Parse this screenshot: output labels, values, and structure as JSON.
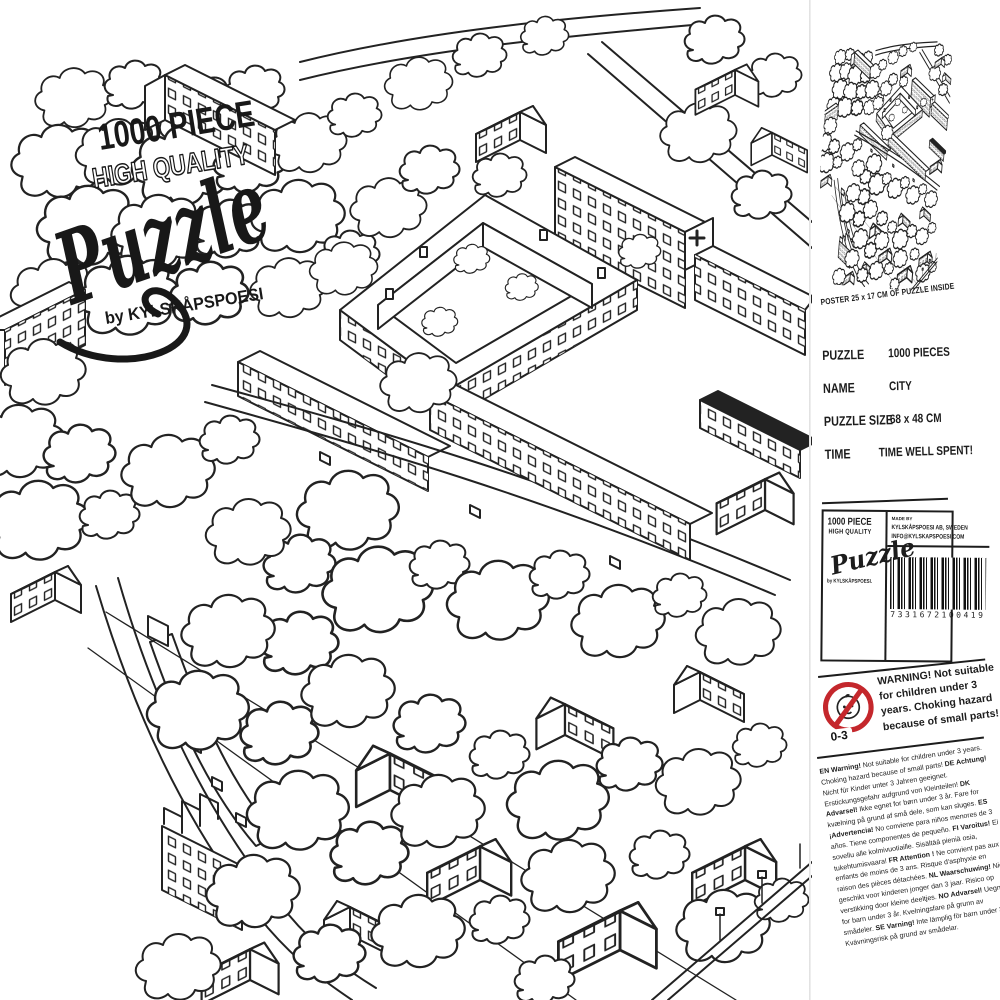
{
  "front": {
    "logo": {
      "line1": "1000 PIECE",
      "line2": "HIGH QUALITY",
      "script": "Puzzle",
      "byline": "by KYLSKÅPSPOESI"
    }
  },
  "side_panel": {
    "poster_caption": "POSTER 25 x 17 CM OF PUZZLE INSIDE",
    "specs": [
      {
        "label": "PUZZLE",
        "value": "1000 PIECES"
      },
      {
        "label": "NAME",
        "value": "CITY"
      },
      {
        "label": "PUZZLE SIZE",
        "value": "68 x 48 CM"
      },
      {
        "label": "TIME",
        "value": "TIME WELL SPENT!"
      }
    ],
    "brand": {
      "line1": "1000 PIECE",
      "line2": "HIGH QUALITY",
      "script": "Puzzle",
      "byline": "by KYLSKÅPSPOESI."
    },
    "maker": {
      "made_by": "MADE BY",
      "company": "KYLSKÅPSPOESI AB, SWEDEN",
      "email": "INFO@KYLSKAPSPOESI.COM"
    },
    "barcode_digits": "7331672100419",
    "warning": {
      "age_label": "0-3",
      "title": "WARNING!",
      "text": "Not suitable for children under 3 years. Choking hazard because of small parts!"
    },
    "multilang": [
      {
        "code": "EN",
        "head": "Warning!",
        "text": "Not suitable for children under 3 years. Choking hazard because of small parts!"
      },
      {
        "code": "DE",
        "head": "Achtung!",
        "text": "Nicht für Kinder unter 3 Jahren geeignet. Erstickungsgefahr aufgrund von Kleinteilen!"
      },
      {
        "code": "DK",
        "head": "Advarsel!",
        "text": "Ikke egnet for børn under 3 år. Fare for kvælning på grund af små dele, som kan sluges."
      },
      {
        "code": "ES",
        "head": "¡Advertencia!",
        "text": "No conviene para niños menores de 3 años. Tiene componentes de pequeño."
      },
      {
        "code": "FI",
        "head": "Varoitus!",
        "text": "Ei sovellu alle kolmivuotiaille. Sisältää pieniä osia, tukehtumisvaara!"
      },
      {
        "code": "FR",
        "head": "Attention !",
        "text": "Ne convient pas aux enfants de moins de 3 ans. Risque d'asphyxie en raison des pièces détachées."
      },
      {
        "code": "NL",
        "head": "Waarschuwing!",
        "text": "Niet geschikt voor kinderen jonger dan 3 jaar. Risico op verstikking door kleine deeltjes."
      },
      {
        "code": "NO",
        "head": "Advarsel!",
        "text": "Uegnet for barn under 3 år. Kvelningsfare på grunn av smådeler."
      },
      {
        "code": "SE",
        "head": "Varning!",
        "text": "Inte lämplig för barn under 3 år. Kvävningsrisk på grund av smådelar."
      }
    ]
  },
  "colors": {
    "ink": "#222222",
    "warning_red": "#c4272c",
    "paper": "#ffffff"
  }
}
